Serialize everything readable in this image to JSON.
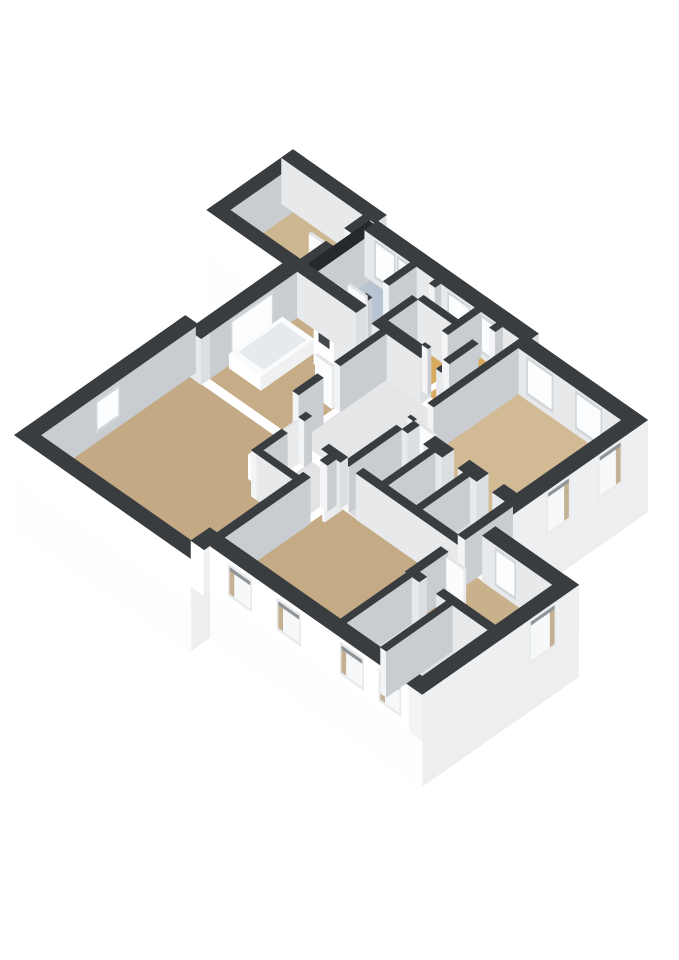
{
  "scene": {
    "title": "3d-floorplan-render",
    "background": "#ffffff",
    "projection": {
      "x0": 382,
      "y0": 258,
      "k": 28.7,
      "m": 20.1,
      "wall_height": 46,
      "plinth_depth": 46
    },
    "palette": {
      "extB": "#ffffff",
      "extA": "#edeff1",
      "intB": "#e7e9eb",
      "intA": "#c9cdd1",
      "capB": "#f3f4f5",
      "capA": "#dcdfe1",
      "top": "#3a3d40",
      "shaftTop": "#26292b",
      "doorB": "#fbfcfd",
      "doorA": "#e9ebed",
      "doorTop": "#e2e4e6",
      "winFrameInt": "#d3d6d8",
      "winGlassInt": "#fcfdfe",
      "winFrameExt": "#e9ebec",
      "winGlassExt": "#f6f8f9",
      "winReveal": "#c4b093",
      "winShade": "#8f9499",
      "tubSide": "#ffffff",
      "tubTop": "#fafbfc",
      "tubInner": "#e7eaec",
      "plinthB": "#fdfdfe",
      "plinthA": "#eceef0"
    },
    "floor_colors": {
      "annex": "#cdb791",
      "blue": "#b8c4d2",
      "tub": "#c7ad87",
      "living": "#c3a984",
      "bedroomR": "#d1ba94",
      "bottomRoom": "#c4ab86",
      "rightTan": "#c9b18c",
      "orange": "#d8ab61",
      "halls": "#e5e6e7",
      "cells": "#d8dadb",
      "corridor": "#e2e3e4",
      "whiteRoom": "#dfe1e2"
    },
    "plinth_edges": [
      {
        "name": "plinth-right-bedroom",
        "p1": [
          9.8,
          0.55
        ],
        "p2": [
          9.8,
          5.85
        ],
        "col": "plinthA"
      },
      {
        "name": "plinth-right-block",
        "p1": [
          12.7,
          5.85
        ],
        "p2": [
          12.7,
          11.3
        ],
        "col": "plinthA"
      },
      {
        "name": "plinth-bottom",
        "p1": [
          12.7,
          11.3
        ],
        "p2": [
          5.3,
          11.3
        ],
        "col": "plinthB"
      },
      {
        "name": "plinth-bottom-step",
        "p1": [
          5.3,
          11.3
        ],
        "p2": [
          5.3,
          11.95
        ],
        "col": "plinthA"
      },
      {
        "name": "plinth-living-bottom",
        "p1": [
          5.3,
          11.95
        ],
        "p2": [
          -0.85,
          11.95
        ],
        "col": "plinthB"
      },
      {
        "name": "plinth-annex-bottom",
        "p1": [
          -0.45,
          3.0
        ],
        "p2": [
          -3.1,
          3.0
        ],
        "col": "plinthB"
      }
    ],
    "floors": [
      {
        "name": "floor-annex-bedroom",
        "rect": [
          -2.75,
          -0.25,
          0.4,
          2.6
        ],
        "col": "annex"
      },
      {
        "name": "floor-blue-bathroom",
        "rect": [
          0.35,
          1.75,
          0.75,
          2.6
        ],
        "col": "blue"
      },
      {
        "name": "floor-hall-a",
        "rect": [
          1.95,
          2.6,
          0.75,
          2.6
        ],
        "col": "halls"
      },
      {
        "name": "floor-room-b",
        "rect": [
          2.8,
          4.0,
          0.75,
          1.35
        ],
        "col": "whiteRoom"
      },
      {
        "name": "floor-orange-hall-1",
        "rect": [
          2.8,
          4.0,
          1.55,
          2.6
        ],
        "col": "orange"
      },
      {
        "name": "floor-orange-hall-2",
        "rect": [
          4.2,
          4.75,
          0.75,
          2.6
        ],
        "col": "orange"
      },
      {
        "name": "floor-room-c",
        "rect": [
          4.95,
          5.55,
          0.75,
          2.6
        ],
        "col": "whiteRoom"
      },
      {
        "name": "floor-bedroom-right",
        "rect": [
          5.75,
          9.35,
          1.0,
          4.65
        ],
        "col": "bedroomR"
      },
      {
        "name": "floor-bathroom-tub",
        "rect": [
          0.0,
          2.9,
          2.95,
          6.0
        ],
        "col": "tub"
      },
      {
        "name": "floor-mid-hall",
        "rect": [
          3.1,
          5.55,
          2.95,
          6.0
        ],
        "col": "halls"
      },
      {
        "name": "floor-corridor",
        "rect": [
          3.85,
          5.1,
          6.3,
          8.0
        ],
        "col": "corridor"
      },
      {
        "name": "floor-living-room",
        "poly": [
          [
            -0.4,
            6.3
          ],
          [
            3.65,
            6.3
          ],
          [
            3.65,
            8.2
          ],
          [
            4.85,
            8.2
          ],
          [
            4.85,
            11.5
          ],
          [
            -0.4,
            11.5
          ]
        ],
        "col": "living"
      },
      {
        "name": "floor-cell-1",
        "rect": [
          5.75,
          6.7,
          5.05,
          6.9
        ],
        "col": "cells"
      },
      {
        "name": "floor-cell-2",
        "rect": [
          6.9,
          7.9,
          5.05,
          6.9
        ],
        "col": "cells"
      },
      {
        "name": "floor-cell-3",
        "rect": [
          8.1,
          9.35,
          5.05,
          6.9
        ],
        "col": "cells"
      },
      {
        "name": "floor-bottom-bedroom",
        "rect": [
          5.35,
          9.6,
          6.95,
          10.85
        ],
        "col": "bottomRoom"
      },
      {
        "name": "floor-right-tan-room",
        "rect": [
          9.6,
          12.25,
          6.3,
          8.3
        ],
        "col": "rightTan"
      },
      {
        "name": "floor-white-room-1",
        "rect": [
          9.6,
          10.8,
          8.55,
          10.85
        ],
        "col": "whiteRoom"
      },
      {
        "name": "floor-white-room-2",
        "rect": [
          11.0,
          12.25,
          8.55,
          10.85
        ],
        "col": "whiteRoom"
      }
    ],
    "walls": [
      {
        "name": "wall-annex-top",
        "rect": [
          -3.1,
          0.15,
          0.0,
          0.4
        ],
        "B": "intB",
        "A": "capA"
      },
      {
        "name": "wall-annex-left",
        "rect": [
          -3.1,
          -2.7,
          0.0,
          3.0
        ],
        "B": "capB",
        "A": "intA"
      },
      {
        "name": "wall-annex-bottom",
        "rect": [
          -3.1,
          -0.2,
          2.6,
          3.0
        ],
        "B": "extB",
        "A": "capA"
      },
      {
        "name": "wall-main-top-1",
        "rect": [
          0.15,
          5.75,
          0.3,
          0.75
        ],
        "B": "intB",
        "A": "capA",
        "win": {
          "face": "B",
          "style": "int",
          "z": [
            8,
            40
          ],
          "spans": [
            [
              0.55,
              1.15
            ],
            [
              1.35,
              1.65
            ],
            [
              3.1,
              3.75
            ],
            [
              4.25,
              4.6
            ]
          ]
        }
      },
      {
        "name": "wall-bedroom-top",
        "rect": [
          5.55,
          9.8,
          0.55,
          1.0
        ],
        "B": "intB",
        "A": "capA",
        "win": {
          "face": "B",
          "style": "int",
          "z": [
            8,
            40
          ],
          "spans": [
            [
              6.1,
              6.9
            ],
            [
              7.8,
              8.6
            ]
          ]
        }
      },
      {
        "name": "wall-bedroom-right",
        "rect": [
          9.35,
          9.8,
          0.55,
          5.85
        ],
        "B": "capB",
        "A": "extA",
        "win": {
          "face": "A",
          "style": "ext",
          "z": [
            4,
            42
          ],
          "spans": [
            [
              1.5,
              2.2
            ],
            [
              3.3,
              4.0
            ]
          ]
        }
      },
      {
        "name": "wall-right-block-top",
        "rect": [
          9.8,
          12.7,
          5.85,
          6.3
        ],
        "B": "intB",
        "A": "capA",
        "win": {
          "face": "B",
          "style": "int",
          "z": [
            8,
            40
          ],
          "spans": [
            [
              10.3,
              10.9
            ]
          ]
        }
      },
      {
        "name": "wall-right-block-right",
        "rect": [
          12.25,
          12.7,
          5.85,
          11.3
        ],
        "B": "capB",
        "A": "extA",
        "win": {
          "face": "A",
          "style": "ext",
          "z": [
            4,
            42
          ],
          "spans": [
            [
              6.7,
              7.5
            ]
          ]
        }
      },
      {
        "name": "wall-bottom-exterior",
        "rect": [
          5.3,
          12.7,
          10.85,
          11.3
        ],
        "B": "extB",
        "A": "capA",
        "win": {
          "face": "B",
          "style": "ext",
          "z": [
            12,
            38
          ],
          "spans": [
            [
              6.0,
              6.7
            ],
            [
              7.7,
              8.4
            ],
            [
              9.9,
              10.6
            ],
            [
              11.25,
              11.9
            ]
          ]
        }
      },
      {
        "name": "wall-bottom-step",
        "rect": [
          4.85,
          5.3,
          10.85,
          11.5
        ],
        "B": "extB",
        "A": "extA"
      },
      {
        "name": "wall-living-bottom",
        "rect": [
          -0.85,
          5.3,
          11.5,
          11.95
        ],
        "B": "extB",
        "A": "extA"
      },
      {
        "name": "wall-living-left",
        "rect": [
          -0.85,
          -0.4,
          6.1,
          11.95
        ],
        "B": "capB",
        "A": "intA",
        "win": {
          "face": "A",
          "style": "int",
          "z": [
            12,
            38
          ],
          "spans": [
            [
              8.8,
              9.5
            ]
          ]
        }
      },
      {
        "name": "wall-left-step",
        "rect": [
          -0.85,
          0.0,
          6.0,
          6.3
        ],
        "B": "intB",
        "A": "capA"
      },
      {
        "name": "wall-tub-left",
        "rect": [
          -0.45,
          0.0,
          2.6,
          6.0
        ],
        "B": "capB",
        "A": "intA",
        "win": {
          "face": "A",
          "style": "int",
          "z": [
            8,
            40
          ],
          "spans": [
            [
              3.85,
              5.2
            ]
          ]
        }
      },
      {
        "name": "wall-annex-right",
        "rect": [
          -0.25,
          0.0,
          0.4,
          2.6
        ],
        "B": "capB",
        "A": "intA",
        "open": [
          [
            1.05,
            1.7
          ]
        ]
      },
      {
        "name": "wall-shaft-block",
        "rect": [
          0.0,
          0.35,
          0.45,
          2.6
        ],
        "B": "intB",
        "A": "intA",
        "top": "shaftTop"
      },
      {
        "name": "wall-blue-right",
        "rect": [
          1.75,
          1.95,
          0.75,
          2.6
        ],
        "B": "capB",
        "A": "intA",
        "open": [
          [
            1.7,
            2.3
          ]
        ]
      },
      {
        "name": "wall-hall-a-right",
        "rect": [
          2.6,
          2.8,
          0.75,
          2.6
        ],
        "B": "capB",
        "A": "intA",
        "open": [
          [
            0.95,
            1.55
          ]
        ]
      },
      {
        "name": "wall-room-b-bottom",
        "rect": [
          2.8,
          4.0,
          1.35,
          1.55
        ],
        "B": "intB",
        "A": "capA"
      },
      {
        "name": "wall-room-b-right",
        "rect": [
          4.0,
          4.2,
          0.75,
          2.6
        ],
        "B": "capB",
        "A": "intA",
        "open": [
          [
            1.9,
            2.5
          ]
        ]
      },
      {
        "name": "wall-orange2-right",
        "rect": [
          4.75,
          4.95,
          0.75,
          2.6
        ],
        "B": "capB",
        "A": "intA",
        "open": [
          [
            1.0,
            1.6
          ]
        ]
      },
      {
        "name": "wall-cluster-bottom",
        "rect": [
          0.0,
          5.75,
          2.6,
          2.95
        ],
        "B": "intB",
        "A": "capA",
        "open": [
          [
            2.05,
            2.6
          ],
          [
            4.3,
            4.85
          ]
        ]
      },
      {
        "name": "wall-tub-right",
        "rect": [
          2.9,
          3.1,
          2.95,
          6.0
        ],
        "B": "capB",
        "A": "intA",
        "open": [
          [
            4.55,
            5.15
          ]
        ]
      },
      {
        "name": "wall-bedroom-left",
        "rect": [
          5.55,
          5.75,
          1.0,
          4.65
        ],
        "B": "capB",
        "A": "intA",
        "open": [
          [
            3.95,
            4.55
          ]
        ]
      },
      {
        "name": "wall-bedroom-bottom",
        "rect": [
          5.75,
          9.35,
          4.65,
          5.05
        ],
        "B": "intB",
        "A": "capA",
        "open": [
          [
            5.95,
            6.5
          ],
          [
            7.15,
            7.7
          ],
          [
            8.35,
            8.9
          ]
        ]
      },
      {
        "name": "wall-cell-1-right",
        "rect": [
          6.7,
          6.9,
          5.05,
          6.9
        ],
        "B": "capB",
        "A": "intA"
      },
      {
        "name": "wall-cell-2-right",
        "rect": [
          7.9,
          8.1,
          5.05,
          6.9
        ],
        "B": "capB",
        "A": "intA"
      },
      {
        "name": "wall-cells-right",
        "rect": [
          9.35,
          9.6,
          5.05,
          8.55
        ],
        "B": "capB",
        "A": "intA",
        "open": [
          [
            6.7,
            7.3
          ]
        ]
      },
      {
        "name": "wall-bottom-room-top",
        "rect": [
          4.85,
          9.6,
          6.7,
          6.95
        ],
        "B": "intB",
        "A": "capA",
        "open": [
          [
            5.5,
            6.05
          ]
        ]
      },
      {
        "name": "wall-right-tan-bottom",
        "rect": [
          9.6,
          12.25,
          8.3,
          8.55
        ],
        "B": "intB",
        "A": "capA",
        "open": [
          [
            9.85,
            10.45
          ]
        ]
      },
      {
        "name": "wall-corridor-left",
        "rect": [
          3.65,
          3.85,
          6.3,
          8.2
        ],
        "B": "capB",
        "A": "intA",
        "open": [
          [
            6.55,
            7.15
          ]
        ]
      },
      {
        "name": "wall-bottom-room-left",
        "rect": [
          5.1,
          5.35,
          6.95,
          10.85
        ],
        "B": "capB",
        "A": "intA",
        "open": [
          [
            7.25,
            7.85
          ]
        ]
      },
      {
        "name": "wall-white-rooms-div",
        "rect": [
          10.8,
          11.0,
          8.55,
          10.85
        ],
        "B": "capB",
        "A": "intA"
      },
      {
        "name": "wall-cell-1-left",
        "rect": [
          5.55,
          5.75,
          5.05,
          6.9
        ],
        "B": "capB",
        "A": "intA"
      },
      {
        "name": "wall-bottom-room-left-2",
        "rect": [
          9.4,
          9.6,
          8.55,
          10.85
        ],
        "B": "capB",
        "A": "intA"
      },
      {
        "name": "wall-corridor-end",
        "rect": [
          3.85,
          5.1,
          8.0,
          8.2
        ],
        "B": "intB",
        "A": "capA"
      }
    ],
    "doors": [
      {
        "name": "door-annex",
        "rect": [
          -0.83,
          -0.25,
          1.63,
          1.71
        ]
      },
      {
        "name": "door-blue-bath",
        "rect": [
          1.13,
          1.73,
          2.24,
          2.31
        ]
      },
      {
        "name": "door-bedroom",
        "rect": [
          5.77,
          6.37,
          4.48,
          4.55
        ]
      },
      {
        "name": "door-bottom-room",
        "rect": [
          5.5,
          5.57,
          6.97,
          7.57
        ]
      },
      {
        "name": "door-tub-room",
        "rect": [
          2.3,
          2.88,
          4.55,
          4.62
        ]
      },
      {
        "name": "door-living",
        "rect": [
          3.58,
          3.65,
          6.57,
          7.17
        ]
      },
      {
        "name": "door-right-tan",
        "rect": [
          9.62,
          10.22,
          7.3,
          7.37
        ]
      }
    ],
    "fixtures": [
      {
        "name": "washing-machine-column",
        "type": "box",
        "rect": [
          1.45,
          2.15,
          3.08,
          3.82
        ],
        "h": 66,
        "B": "extB",
        "A": "doorA",
        "top": "capB",
        "detail": {
          "face": "B",
          "span": [
            1.62,
            1.98
          ],
          "z": [
            26,
            48
          ],
          "col": "#43474b"
        }
      },
      {
        "name": "bathtub",
        "type": "tub",
        "rect": [
          0.08,
          1.18,
          3.55,
          5.4
        ],
        "h": 14,
        "inner": [
          0.2,
          1.06,
          3.72,
          5.18
        ]
      },
      {
        "name": "living-room-unit",
        "type": "box",
        "rect": [
          3.16,
          3.56,
          7.08,
          7.82
        ],
        "h": 24,
        "B": "extB",
        "A": "doorA",
        "top": "capB"
      },
      {
        "name": "toilet-unit",
        "type": "box",
        "rect": [
          6.0,
          6.45,
          5.35,
          5.95
        ],
        "h": 16,
        "B": "extB",
        "A": "doorA",
        "top": "capB"
      }
    ]
  }
}
